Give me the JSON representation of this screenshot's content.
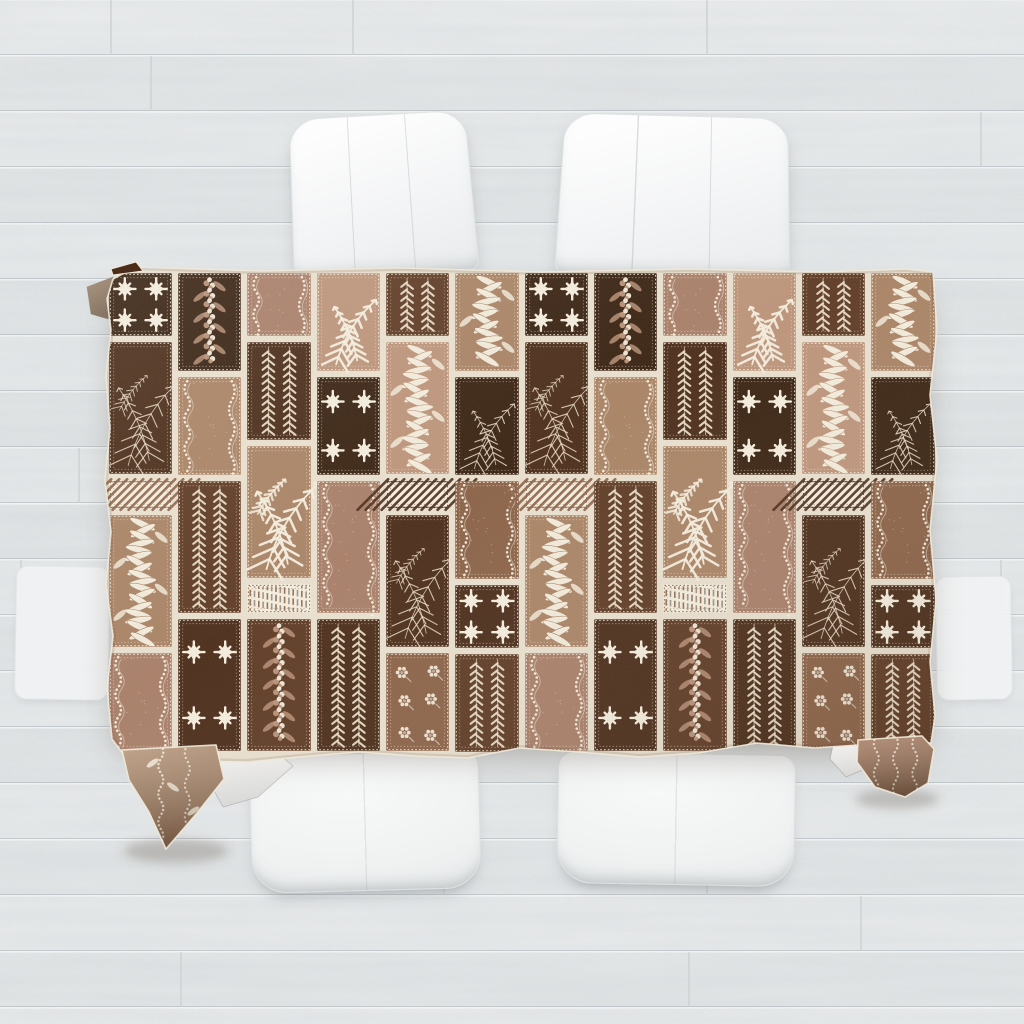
{
  "meta": {
    "type": "product-photo",
    "subject": "Rectangular tablecloth with brown Polynesian tapa patchwork print, top-down view",
    "setting": "Whitewashed wood plank floor, two white chairs at top, two white chair seats at bottom"
  },
  "palette": {
    "darkest": "#392312",
    "dark": "#4b2d1a",
    "choc": "#5e3b25",
    "med": "#8a6247",
    "tan": "#a88264",
    "rosy": "#a77e68",
    "light": "#bb9379",
    "cream": "#e9dcc6",
    "paper": "#f3ecdc",
    "base": "#e8decd",
    "gray": "#8f8a83",
    "hem": "#f1e9d8"
  },
  "floor": {
    "base": "#e9ebec",
    "seam": "#ced3d4",
    "plank_height": 56,
    "joints": [
      [
        110,
        0
      ],
      [
        352,
        0
      ],
      [
        706,
        0
      ],
      [
        150,
        56
      ],
      [
        980,
        112
      ],
      [
        78,
        448
      ],
      [
        20,
        560
      ],
      [
        1000,
        560
      ],
      [
        235,
        616
      ],
      [
        443,
        840
      ],
      [
        706,
        840
      ],
      [
        688,
        952
      ],
      [
        180,
        952
      ],
      [
        860,
        896
      ]
    ]
  },
  "chairs": {
    "back_left": {
      "x": 294,
      "y": 101,
      "w": 184,
      "h": 172,
      "rot": -3.5
    },
    "back_right": {
      "x": 554,
      "y": 102,
      "w": 234,
      "h": 172,
      "rot": 1.6
    },
    "seat_left": {
      "x": 252,
      "y": 753,
      "w": 228,
      "h": 136,
      "rot": -1.5
    },
    "seat_right": {
      "x": 556,
      "y": 753,
      "w": 236,
      "h": 130,
      "rot": 1
    },
    "side_left": {
      "x": 14,
      "y": 566,
      "w": 92,
      "h": 132,
      "rot": 1
    },
    "side_right": {
      "x": 937,
      "y": 576,
      "w": 74,
      "h": 122,
      "rot": -1
    }
  },
  "hardware": {
    "top_bars": [
      [
        464,
        239,
        5,
        21,
        7
      ],
      [
        541,
        246,
        5,
        22,
        -3
      ]
    ],
    "side_dashes": [
      [
        72,
        621,
        20,
        4,
        2
      ],
      [
        74,
        628,
        21,
        4,
        2
      ],
      [
        946,
        625,
        17,
        4,
        -1
      ],
      [
        947,
        631,
        17,
        4,
        -1
      ]
    ],
    "bracket": {
      "strip": [
        488,
        762,
        62,
        32
      ],
      "bars": [
        [
          483,
          768,
          6,
          20
        ],
        [
          548,
          767,
          6,
          20
        ]
      ],
      "legs": [
        [
          489,
          792,
          3,
          22
        ],
        [
          552,
          791,
          3,
          22
        ]
      ]
    }
  },
  "tablecloth": {
    "x": 106,
    "y": 270,
    "width": 830,
    "height": 492,
    "repeat_offsets": [
      0,
      416
    ],
    "outline": {
      "top": [
        [
          135,
          267
        ],
        [
          260,
          271
        ],
        [
          400,
          268
        ],
        [
          540,
          272
        ],
        [
          690,
          269
        ],
        [
          820,
          272
        ],
        [
          906,
          269
        ],
        [
          933,
          272
        ]
      ],
      "right": [
        [
          937,
          330
        ],
        [
          930,
          395
        ],
        [
          937,
          460
        ],
        [
          930,
          530
        ],
        [
          936,
          600
        ],
        [
          930,
          662
        ],
        [
          935,
          716
        ],
        [
          931,
          743
        ]
      ],
      "bottom": [
        [
          900,
          741
        ],
        [
          858,
          745
        ],
        [
          815,
          748
        ],
        [
          757,
          743
        ],
        [
          698,
          753
        ],
        [
          640,
          757
        ],
        [
          578,
          752
        ],
        [
          519,
          748
        ],
        [
          468,
          758
        ],
        [
          415,
          756
        ],
        [
          358,
          752
        ],
        [
          299,
          757
        ],
        [
          248,
          762
        ],
        [
          197,
          761
        ],
        [
          158,
          766
        ],
        [
          129,
          762
        ]
      ],
      "left": [
        [
          112,
          739
        ],
        [
          107,
          688
        ],
        [
          113,
          636
        ],
        [
          106,
          584
        ],
        [
          111,
          532
        ],
        [
          105,
          480
        ],
        [
          110,
          428
        ],
        [
          106,
          376
        ],
        [
          111,
          330
        ],
        [
          107,
          299
        ],
        [
          113,
          279
        ]
      ]
    },
    "columns": [
      {
        "x": 0,
        "w": 69,
        "stack": [
          [
            "quilt",
            69,
            "darkest",
            "paper"
          ],
          [
            "fern",
            138,
            "dark",
            "cream",
            "outline"
          ],
          [
            "hatch",
            35,
            "paper",
            "med"
          ],
          [
            "lei",
            138,
            "tan",
            "paper"
          ],
          [
            "waves",
            104,
            "rosy",
            "paper"
          ]
        ]
      },
      {
        "x": 69,
        "w": 69,
        "stack": [
          [
            "florallei",
            104,
            "darkest",
            "paper",
            "light"
          ],
          [
            "waves",
            104,
            "tan",
            "paper"
          ],
          [
            "leaves",
            138,
            "choc",
            "cream"
          ],
          [
            "quilt",
            138,
            "dark",
            "paper"
          ]
        ]
      },
      {
        "x": 138,
        "w": 70,
        "stack": [
          [
            "waves",
            69,
            "rosy",
            "paper"
          ],
          [
            "leaves",
            104,
            "dark",
            "cream"
          ],
          [
            "fern",
            138,
            "tan",
            "paper",
            "solid"
          ],
          [
            "stripe",
            35,
            "paper",
            "med",
            "gray"
          ],
          [
            "florallei",
            138,
            "choc",
            "paper",
            "light"
          ]
        ]
      },
      {
        "x": 208,
        "w": 69,
        "stack": [
          [
            "fern",
            104,
            "light",
            "paper",
            "solid"
          ],
          [
            "quilt",
            104,
            "darkest",
            "paper"
          ],
          [
            "waves",
            138,
            "rosy",
            "paper"
          ],
          [
            "leaves",
            138,
            "dark",
            "cream"
          ]
        ]
      },
      {
        "x": 277,
        "w": 69,
        "stack": [
          [
            "leaves",
            69,
            "choc",
            "cream"
          ],
          [
            "lei",
            138,
            "light",
            "paper"
          ],
          [
            "hatch",
            35,
            "paper",
            "dark"
          ],
          [
            "fern",
            138,
            "dark",
            "cream",
            "outline"
          ],
          [
            "floral",
            104,
            "med",
            "paper"
          ]
        ]
      },
      {
        "x": 346,
        "w": 70,
        "stack": [
          [
            "lei",
            104,
            "tan",
            "paper"
          ],
          [
            "fern",
            104,
            "darkest",
            "cream",
            "outline"
          ],
          [
            "waves",
            104,
            "med",
            "paper"
          ],
          [
            "quilt",
            69,
            "dark",
            "paper"
          ],
          [
            "leaves",
            104,
            "choc",
            "cream"
          ]
        ]
      }
    ],
    "drapes": [
      {
        "id": "drapeL",
        "points": [
          [
            122,
            750
          ],
          [
            216,
            745
          ],
          [
            224,
            779
          ],
          [
            197,
            813
          ],
          [
            166,
            849
          ],
          [
            149,
            812
          ],
          [
            129,
            780
          ]
        ],
        "grad": "tanGrad",
        "deco": "lei"
      },
      {
        "id": "drapeR",
        "points": [
          [
            858,
            740
          ],
          [
            922,
            736
          ],
          [
            934,
            749
          ],
          [
            928,
            783
          ],
          [
            905,
            797
          ],
          [
            875,
            787
          ],
          [
            857,
            762
          ]
        ],
        "grad": "rosyGrad",
        "deco": "waves"
      }
    ],
    "folds": [
      {
        "id": "foldLW",
        "points": [
          [
            208,
            748
          ],
          [
            268,
            745
          ],
          [
            293,
            766
          ],
          [
            258,
            797
          ],
          [
            223,
            807
          ],
          [
            206,
            776
          ]
        ],
        "grad": "whiteGrad"
      },
      {
        "id": "foldRW",
        "points": [
          [
            834,
            741
          ],
          [
            866,
            741
          ],
          [
            872,
            766
          ],
          [
            846,
            777
          ],
          [
            830,
            759
          ]
        ],
        "grad": "whiteGrad"
      },
      {
        "id": "foldTL",
        "points": [
          [
            87,
            287
          ],
          [
            113,
            277
          ],
          [
            117,
            300
          ],
          [
            108,
            319
          ],
          [
            91,
            314
          ]
        ],
        "grad": "mutedGrad"
      }
    ],
    "bump": [
      [
        111,
        269
      ],
      [
        136,
        262
      ],
      [
        143,
        271
      ],
      [
        113,
        275
      ]
    ],
    "drape_shadows": [
      [
        176,
        851,
        52,
        12
      ],
      [
        897,
        799,
        42,
        10
      ]
    ]
  }
}
